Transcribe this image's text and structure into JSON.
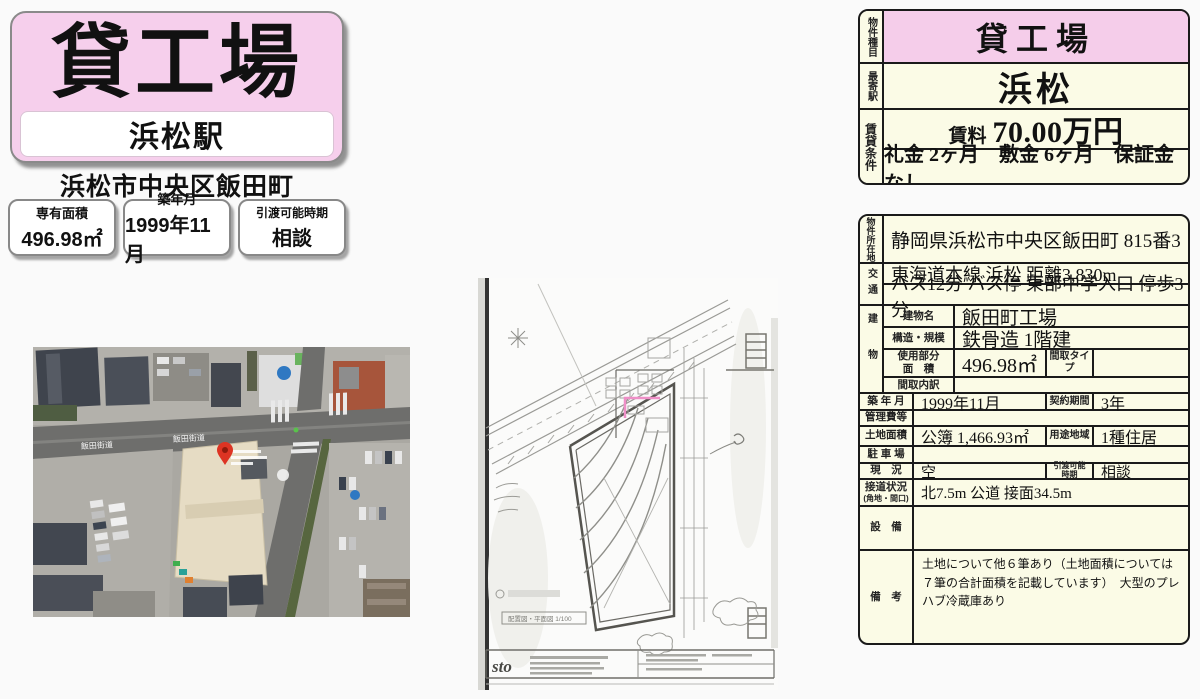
{
  "colors": {
    "accent_pink": "#f5cdea",
    "cream": "#fbfbe6",
    "pin_red": "#dd3423"
  },
  "flyer": {
    "title": "貸工場",
    "station": "浜松駅",
    "address": "浜松市中央区飯田町",
    "badges": [
      {
        "label": "専有面積",
        "value": "496.98㎡"
      },
      {
        "label": "築年月",
        "value": "1999年11月"
      },
      {
        "label": "引渡可能時期",
        "value": "相談"
      }
    ]
  },
  "map": {
    "road_label": "飯田街道"
  },
  "plan": {
    "logo": "sto",
    "caption": "配置図・平面図 1/100"
  },
  "summary": {
    "type_label": "物件種目",
    "type_value": "貸工場",
    "station_label": "最寄駅",
    "station_value": "浜松",
    "terms_label": "賃貸条件",
    "rent_label": "賃料",
    "rent_value": "70.00万円",
    "terms_value": "礼金 2ヶ月　敷金 6ヶ月　保証金 なし"
  },
  "detail": {
    "location_label": "物件所在地",
    "location": "静岡県浜松市中央区飯田町 815番3",
    "access_label": "交通",
    "access1": "東海道本線 浜松 距離3,830m",
    "access2": "バス12分 バス停 東部中学入口 停歩3分",
    "building_label": "建物",
    "building_name_label": "建物名",
    "building_name": "飯田町工場",
    "structure_label": "構造・規模",
    "structure": "鉄骨造 1階建",
    "used_area_label1": "使用部分",
    "used_area_label2": "面　積",
    "used_area": "496.98㎡",
    "madori_type_label": "間取タイプ",
    "madori_type": "",
    "madori_detail_label": "間取内訳",
    "madori_detail": "",
    "built_label": "築 年 月",
    "built": "1999年11月",
    "contract_label": "契約期間",
    "contract": "3年",
    "mgmt_label": "管理費等",
    "mgmt": "",
    "land_label": "土地面積",
    "land": "公簿 1,466.93㎡",
    "zoning_label": "用途地域",
    "zoning": "1種住居",
    "parking_label": "駐 車 場",
    "parking": "",
    "status_label": "現　況",
    "status": "空",
    "handover_label1": "引渡可能",
    "handover_label2": "時期",
    "handover": "相談",
    "road_label1": "接道状況",
    "road_label2": "(角地・間口)",
    "road": "北7.5m 公道 接面34.5m",
    "equipment_label": "設　備",
    "equipment": "",
    "remarks_label": "備　考",
    "remarks": "土地について他６筆あり（土地面積については７筆の合計面積を記載しています）　大型のプレハブ冷蔵庫あり"
  }
}
